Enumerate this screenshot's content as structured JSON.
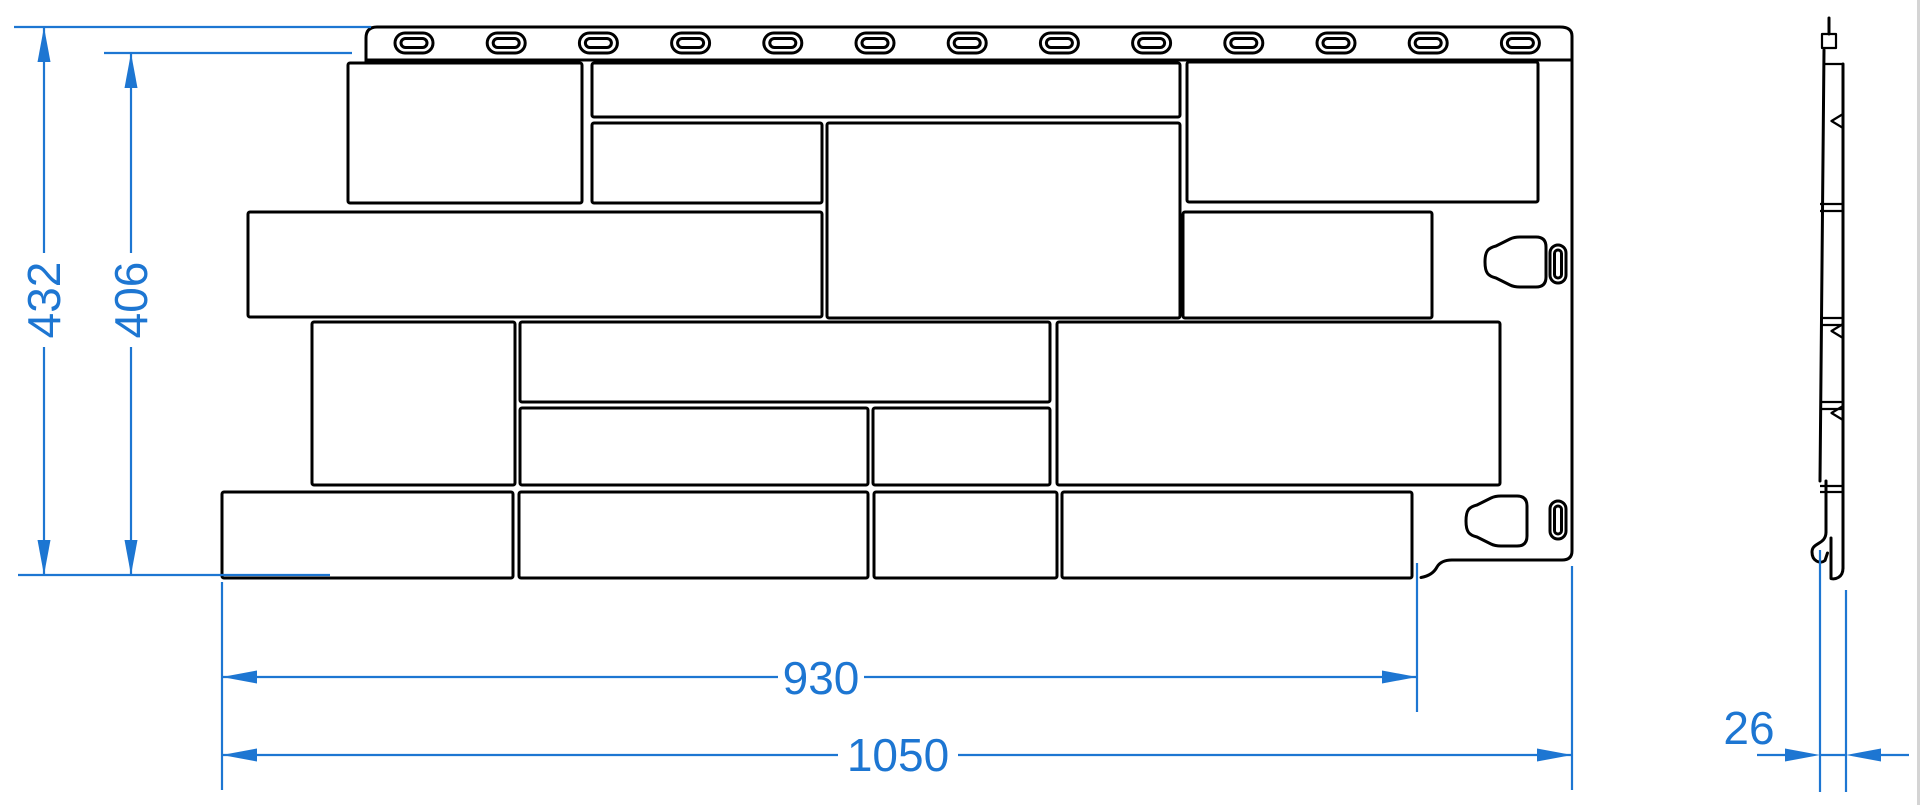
{
  "title": "Facade panel technical drawing",
  "dimensions": {
    "overall_height_mm": "432",
    "visible_height_mm": "406",
    "stone_area_width_mm": "930",
    "overall_width_mm": "1050",
    "thickness_mm": "26"
  },
  "views": {
    "front": {
      "nail_slot_count": 13,
      "stone_block_count": 16,
      "mounting_clip_count": 2,
      "clip_slot_count": 2
    },
    "side": {
      "row_step_count": 4
    }
  },
  "colors": {
    "dimension": "#1d76d2",
    "outline": "#000000",
    "background": "#ffffff"
  }
}
